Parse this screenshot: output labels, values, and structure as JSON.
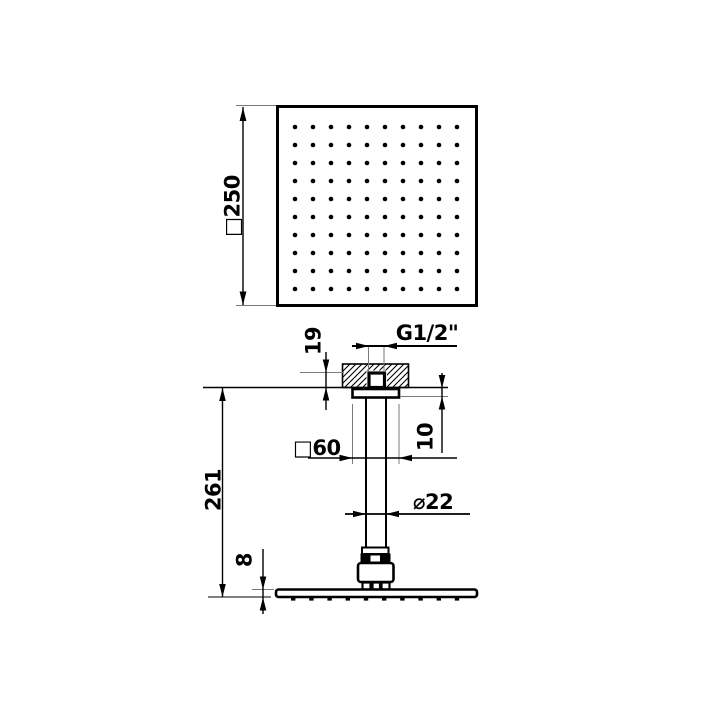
{
  "labels": {
    "top_size": "□250",
    "thread": "G1/2\"",
    "embed_depth": "19",
    "rosette_height": "10",
    "rosette_size": "□60",
    "total_height": "261",
    "arm_diameter": "⌀22",
    "head_thickness": "8"
  },
  "nozzles": {
    "rows": 10,
    "columns": 10
  },
  "colors": {
    "line": "#000000",
    "extension_line": "#7a7a7a",
    "background": "#ffffff"
  }
}
